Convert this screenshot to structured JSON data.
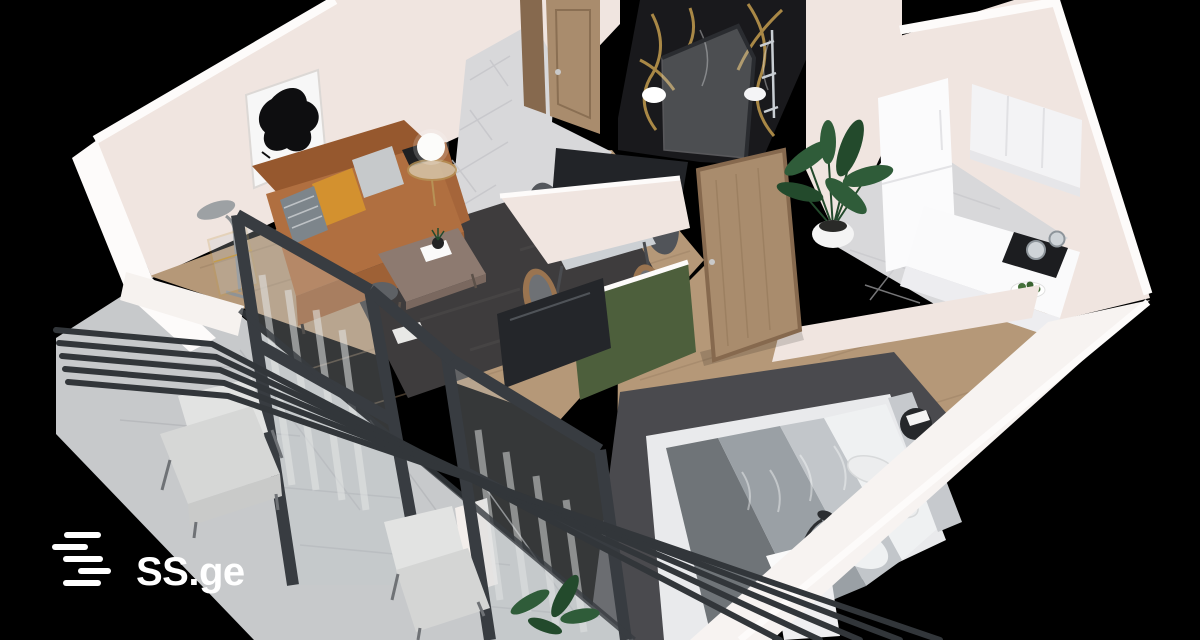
{
  "logo": {
    "text": "SS.ge",
    "icon": "ss-stripes-icon"
  },
  "scene": {
    "type": "3d-floorplan-render",
    "style": "isometric-cutaway-apartment",
    "background": "black",
    "rooms": [
      {
        "name": "living-room",
        "items": [
          "abstract-art-print",
          "leather-sofa",
          "orange-pillow",
          "gray-pillow",
          "striped-pillow",
          "floor-lamp",
          "glass-etagere",
          "globe-lamp",
          "brass-side-table",
          "coffee-table",
          "side-stool",
          "magazine",
          "dark-gray-rug"
        ]
      },
      {
        "name": "dining-area",
        "items": [
          "marble-dining-table",
          "gray-chair",
          "gray-chair",
          "wood-chair",
          "wood-chair",
          "gold-bowl",
          "gold-cup",
          "decor-plate"
        ]
      },
      {
        "name": "hallway",
        "items": [
          "entrance-door",
          "tile-floor"
        ]
      },
      {
        "name": "bathroom",
        "items": [
          "black-gold-marble-wall",
          "glass-shower",
          "sink",
          "toilet",
          "chrome-fixtures"
        ]
      },
      {
        "name": "kitchen",
        "items": [
          "tall-fridge-cabinet",
          "upper-cabinets",
          "counter",
          "induction-cooktop",
          "cooking-pots",
          "fruit-plate",
          "tile-floor"
        ]
      },
      {
        "name": "bedroom",
        "items": [
          "platform-bed",
          "gray-bedding",
          "white-duvet",
          "pillows",
          "dark-rug",
          "round-side-table",
          "nightstand",
          "desk-lamp",
          "wooden-door",
          "green-accent-partition",
          "tv"
        ]
      },
      {
        "name": "balcony",
        "items": [
          "metal-railing",
          "lounge-armchair",
          "lounge-armchair",
          "potted-plant",
          "glazed-window-wall",
          "stone-tile-floor"
        ]
      }
    ]
  },
  "colors": {
    "bg": "#000000",
    "wall": "#f0e5e0",
    "wall-bright": "#fdfbfa",
    "wall-shade": "#e2d4ce",
    "wood": "#b59878",
    "wood-line": "#9a7f62",
    "tile": "#d8d8da",
    "tile-line": "#c4c4c8",
    "balcony": "#c7c9cb",
    "balcony-line": "#b2b4b6",
    "rug": "#3e3c3d",
    "rug-bed": "#4a4a4e",
    "railing": "#32363a",
    "frame": "#383c41",
    "glass": "#c3c9cd",
    "curtain": "#e3e5e6",
    "sofa": "#b06f40",
    "sofa-dark": "#96582e",
    "sofa-front": "#9e6136",
    "pillow-orange": "#d3912f",
    "pillow-gray": "#c6c9cb",
    "pillow-stripe": "#7d858b",
    "coffee": "#8d7a70",
    "stool": "#5e6165",
    "marble": "#19191c",
    "gold": "#c39c4e",
    "door": "#a98c6d",
    "door-edge": "#86694e",
    "green": "#4d5f3c",
    "tv": "#24262a",
    "bed-frame": "#e9eaec",
    "bed-dark": "#6f7478",
    "bed-mid": "#9aa0a5",
    "bed-light": "#c2c6ca",
    "duvet": "#eff1f2",
    "headboard": "#c6c9cd",
    "metal": "#2c2e31",
    "plant": "#2f5c39",
    "plant-dark": "#234a2c",
    "pot": "#f4f4f4",
    "chair-dark": "#54575c",
    "chair-wood": "#9a7450",
    "table-marble": "#ccd0d4",
    "silver": "#c9ced3",
    "white": "#ffffff",
    "logo": "#ffffff"
  }
}
